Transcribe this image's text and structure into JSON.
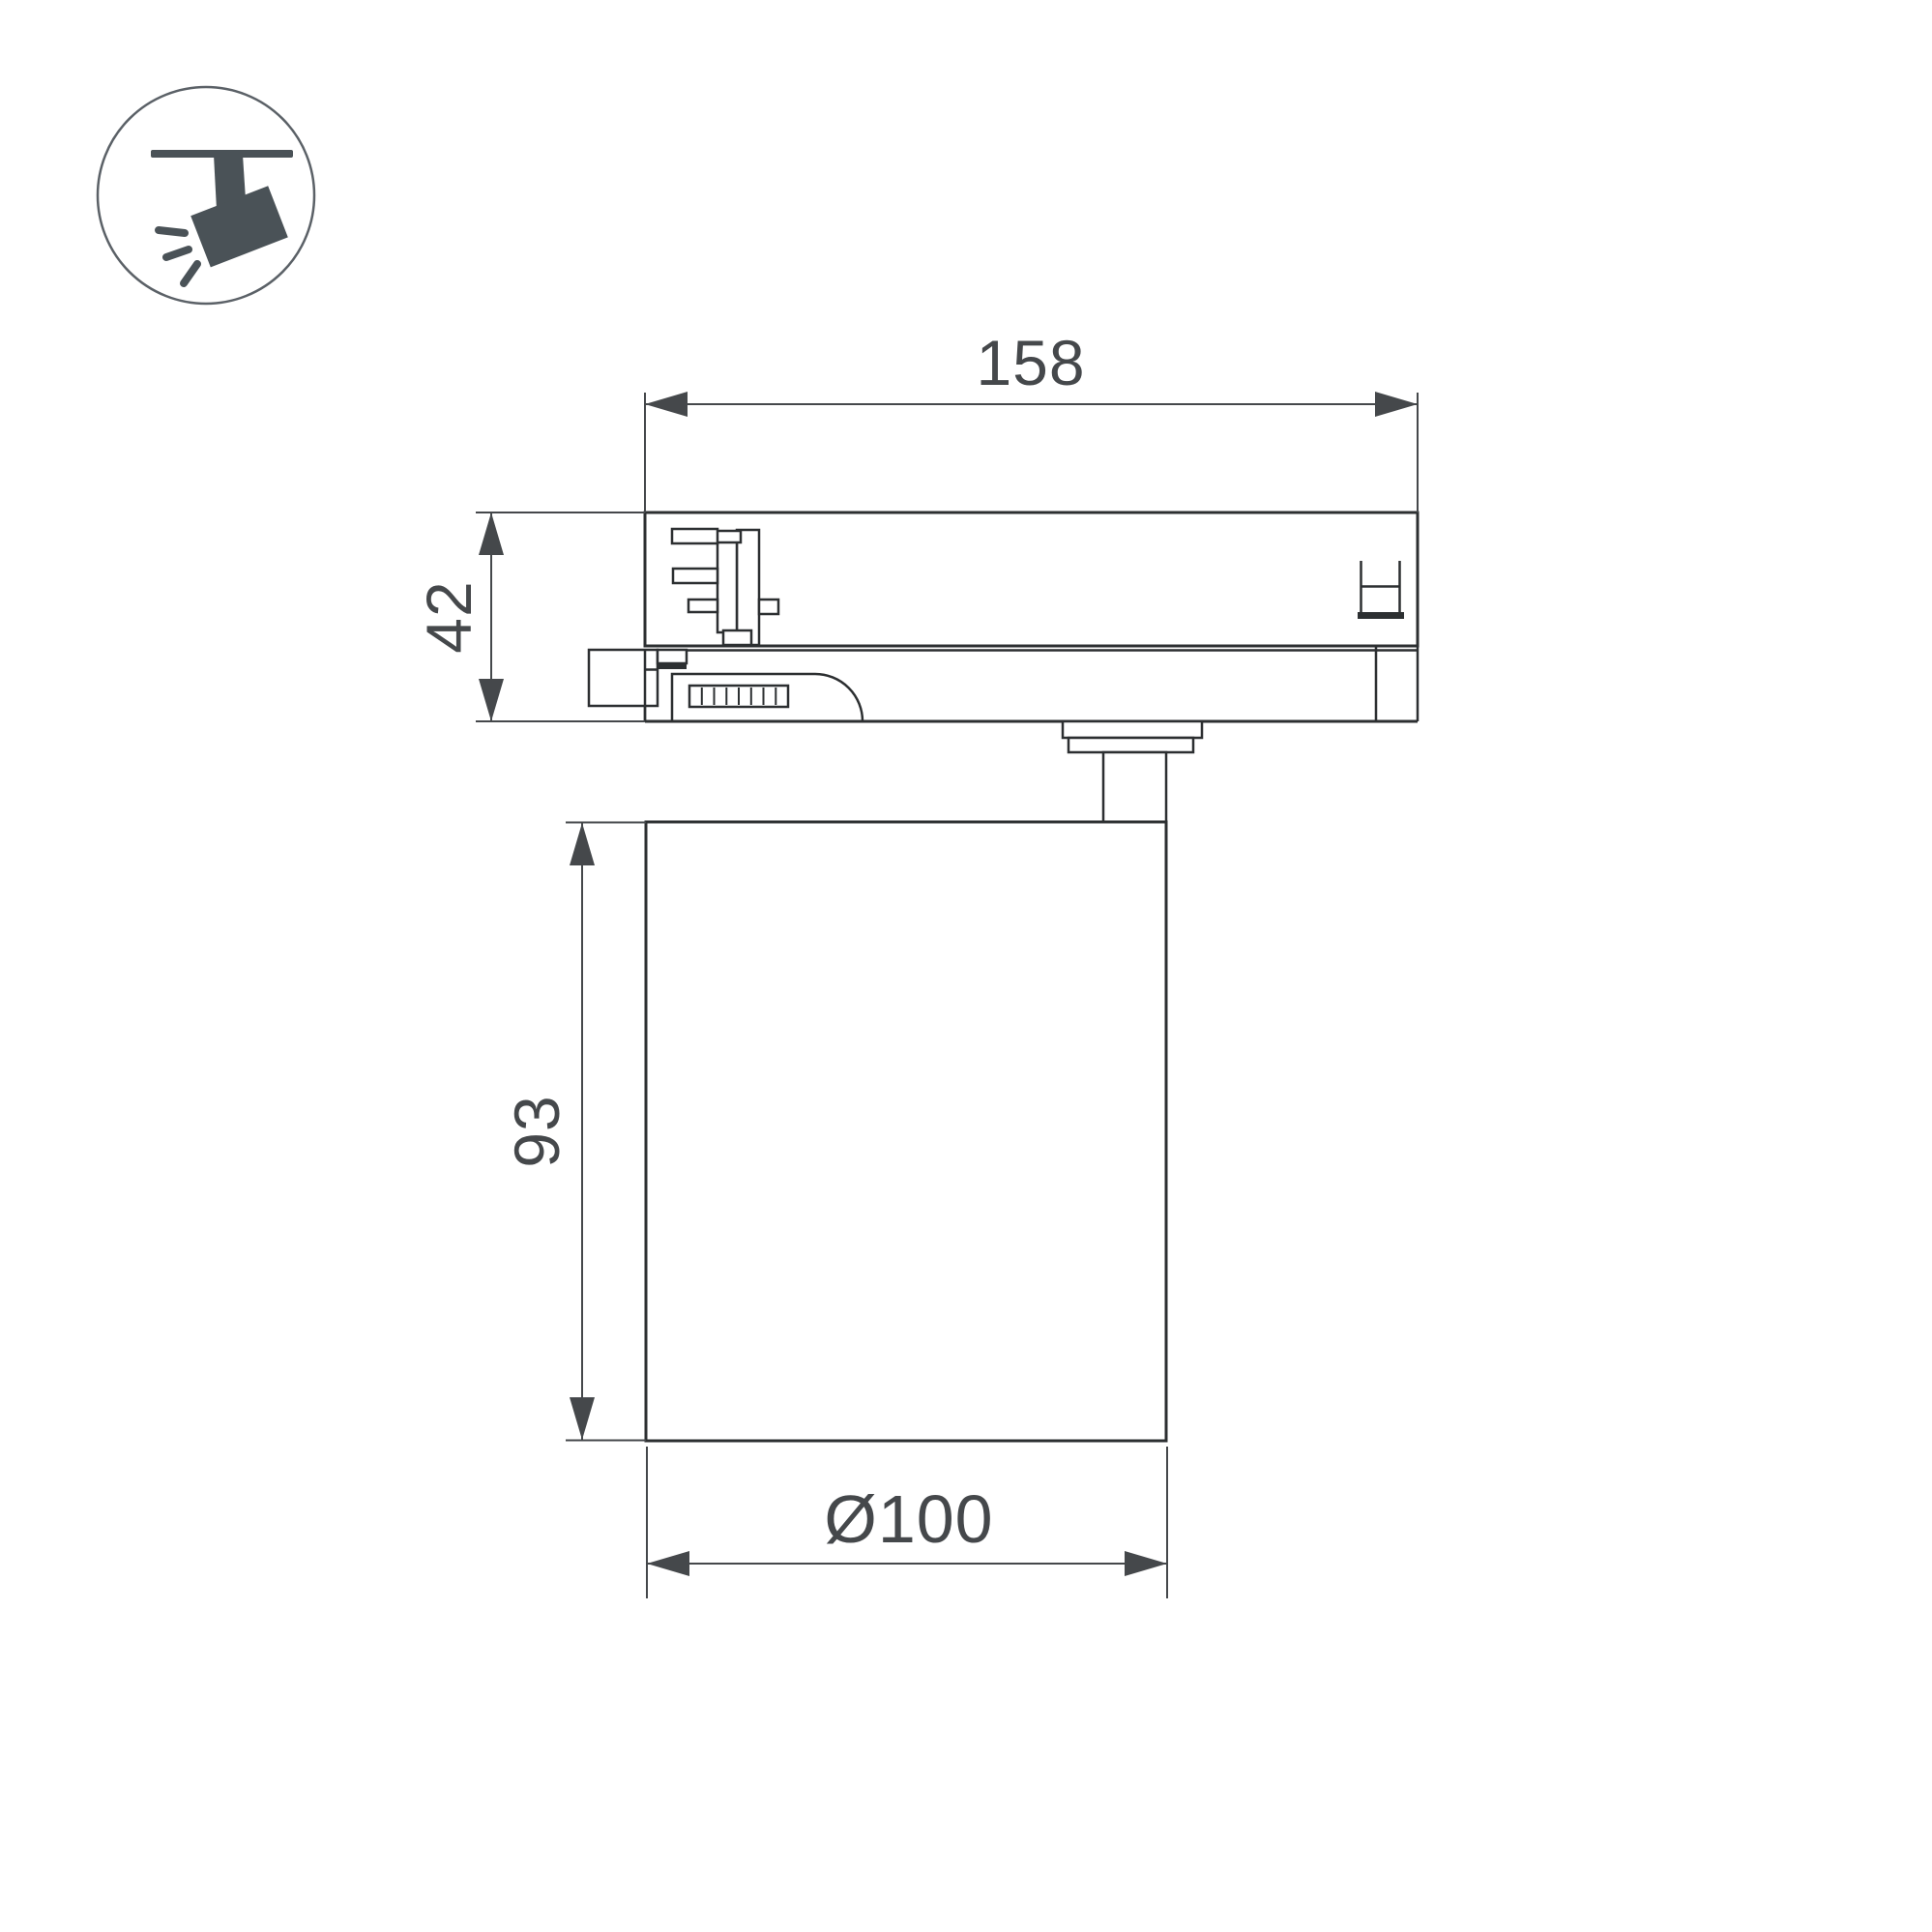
{
  "colors": {
    "bg": "#ffffff",
    "ink": "#2c2f31",
    "dim": "#45484b",
    "icon": "#4a5257",
    "icon_circle": "#5b6167"
  },
  "icon": {
    "semantic": "track-mounted adjustable spotlight pictogram"
  },
  "drawing": {
    "view": "side view of 3-phase track light fixture",
    "dimensions": {
      "track_adapter_width": {
        "label": "158"
      },
      "track_adapter_height": {
        "label": "42"
      },
      "lamp_body_height": {
        "label": "93"
      },
      "lamp_body_diameter": {
        "label": "Ø100"
      }
    }
  }
}
